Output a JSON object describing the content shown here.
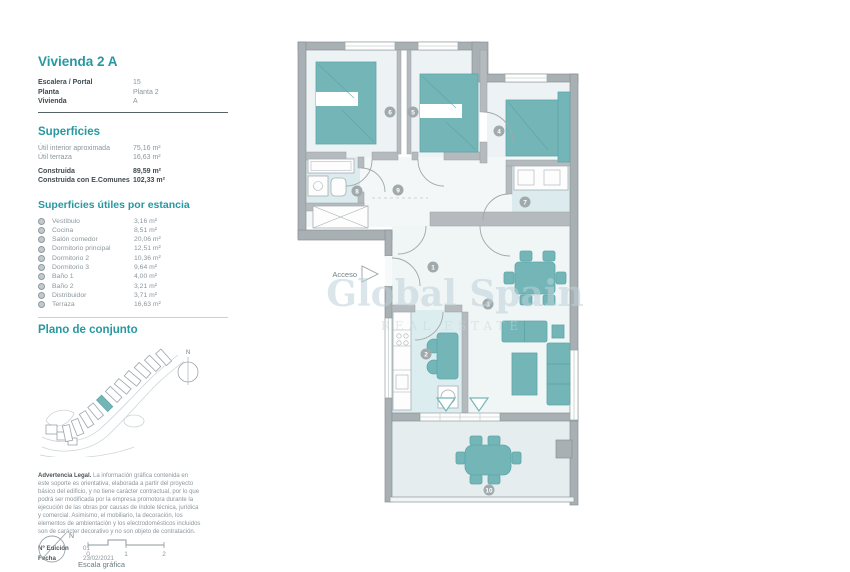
{
  "panel": {
    "title": "Vivienda 2 A",
    "info": {
      "rows": [
        {
          "label": "Escalera / Portal",
          "value": "15"
        },
        {
          "label": "Planta",
          "value": "Planta 2"
        },
        {
          "label": "Vivienda",
          "value": "A"
        }
      ]
    },
    "superficies": {
      "heading": "Superficies",
      "rows": [
        {
          "label": "Útil interior aproximada",
          "value": "75,16 m²"
        },
        {
          "label": "Útil terraza",
          "value": "16,63 m²"
        },
        {
          "label": "Construida",
          "value": "89,59 m²"
        },
        {
          "label": "Construida con E.Comunes",
          "value": "102,33 m²"
        }
      ]
    },
    "estancias": {
      "heading": "Superficies útiles por estancia",
      "rows": [
        {
          "label": "Vestíbulo",
          "value": "3,16 m²"
        },
        {
          "label": "Cocina",
          "value": "8,51 m²"
        },
        {
          "label": "Salón comedor",
          "value": "20,06 m²"
        },
        {
          "label": "Dormitorio principal",
          "value": "12,51 m²"
        },
        {
          "label": "Dormitorio 2",
          "value": "10,36 m²"
        },
        {
          "label": "Dormitorio 3",
          "value": "9,64 m²"
        },
        {
          "label": "Baño 1",
          "value": "4,00 m²"
        },
        {
          "label": "Baño 2",
          "value": "3,21 m²"
        },
        {
          "label": "Distribuidor",
          "value": "3,71 m²"
        },
        {
          "label": "Terraza",
          "value": "16,63 m²"
        }
      ]
    },
    "plano": {
      "heading": "Plano de conjunto",
      "north_label": "N"
    },
    "legal": {
      "title": "Advertencia Legal.",
      "body": "La información gráfica contenida en este soporte es orientativa, elaborada a partir del proyecto básico del edificio, y no tiene carácter contractual, por lo que podrá ser modificada por la empresa promotora durante la ejecución de las obras por causas de índole técnica, jurídica y comercial. Asimismo, el mobiliario, la decoración, los elementos de ambientación y los electrodomésticos incluidos son de carácter decorativo y no son objeto de contratación."
    },
    "edition": {
      "label": "Nº Edición",
      "value": "01"
    },
    "fecha": {
      "label": "Fecha",
      "value": "23/02/2021"
    },
    "scale": {
      "north_label": "N",
      "ticks": [
        "0",
        "1",
        "2"
      ],
      "caption": "Escala gráfica"
    }
  },
  "plan": {
    "access_label": "Acceso",
    "watermark_line1": "Global Spain",
    "watermark_line2": "REAL ESTATE",
    "markers": [
      "1",
      "2",
      "3",
      "4",
      "5",
      "6",
      "7",
      "8",
      "9",
      "10"
    ]
  },
  "colors": {
    "accent_teal": "#2798a1",
    "furniture_teal": "#74b6b8",
    "wall_gray": "#a9b0b3",
    "bath_floor": "#dcebee",
    "kitchen_floor": "#dcedf0"
  }
}
